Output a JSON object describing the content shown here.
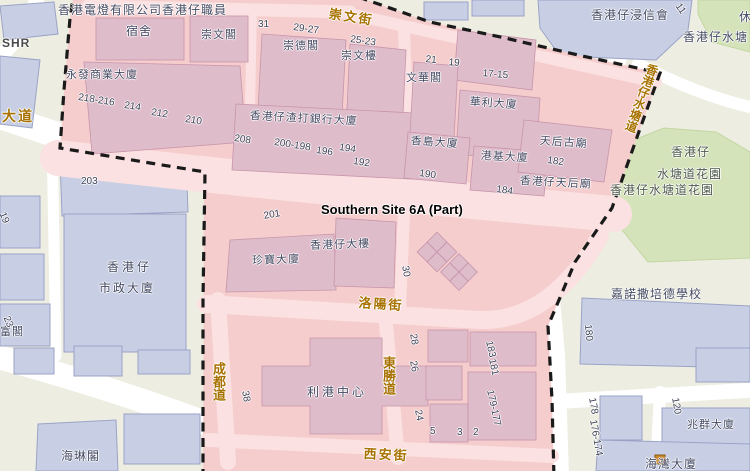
{
  "map": {
    "site_title": "Southern Site 6A (Part)",
    "streets": {
      "chung_man_street": "崇文街",
      "main_road_partial": "大道",
      "lok_yeung_street": "洛陽街",
      "shing_too_road": "成都道",
      "tung_sing_road": "東勝道",
      "sai_on_street": "西安街",
      "aberdeen_reservoir_road": "香港仔水塘道"
    },
    "site_buildings": {
      "hk_electric_staff": "香港電燈有限公司香港仔職員",
      "dormitory": "宿舍",
      "sung_man_court": "崇文閣",
      "wing_fat_commercial": "永發商業大廈",
      "sung_tak_court": "崇德閣",
      "sung_man_house": "崇文樓",
      "man_wah_court": "文華閣",
      "wah_lee_building": "華利大廈",
      "standard_chartered": "香港仔渣打銀行大廈",
      "heung_do_building": "香島大廈",
      "kong_kai_building": "港基大廈",
      "tin_hau_old_temple": "天后古廟",
      "aberdeen_tin_hau_temple": "香港仔天后廟",
      "jumbo_building": "珍寶大廈",
      "aberdeen_building": "香港仔大樓",
      "lee_kong_centre": "利港中心"
    },
    "nearby": {
      "municipal_services_line1": "香港仔",
      "municipal_services_line2": "市政大廈",
      "fu_court_partial": "富閣",
      "hoi_lam_court": "海琳閣",
      "aberdeen_baptist_church": "香港仔浸信會",
      "canossa_school": "嘉諾撒培德學校",
      "siu_kwan_mansion": "兆群大廈",
      "hoi_wan_mansion_partial": "海灣大廈",
      "park_line1": "香港仔",
      "park_line2": "水塘道花園",
      "park_full": "香港仔水塘道花園",
      "reservoir_partial": "香港仔水塘",
      "rest_garden_partial": "休",
      "shr_partial": "SHR"
    },
    "numbers": {
      "n31": "31",
      "n29_27": "29-27",
      "n25_23": "25-23",
      "n21": "21",
      "n19": "19",
      "n17_15": "17-15",
      "n218_216": "218-216",
      "n214": "214",
      "n212": "212",
      "n210": "210",
      "n208": "208",
      "n200_198": "200-198",
      "n196": "196",
      "n194": "194",
      "n192": "192",
      "n190": "190",
      "n184": "184",
      "n182": "182",
      "n203": "203",
      "n201": "201",
      "n30": "30",
      "n38": "38",
      "n28": "28",
      "n26": "26",
      "n24": "24",
      "n5": "5",
      "n3": "3",
      "n2": "2",
      "n183": "183",
      "n181": "181",
      "n179_177": "179-177",
      "n180": "180",
      "n178": "178",
      "n176_174": "176-174",
      "n120": "120",
      "n11": "11",
      "n19_left": "19",
      "n23_left": "23"
    },
    "colors": {
      "site_fill": "#f5cdcd",
      "site_building": "#dfbcca",
      "street_label": "#a87200",
      "boundary": "#1a1a1a",
      "outside_building": "#c8cfe4",
      "park_green": "#d5e3ba"
    }
  }
}
